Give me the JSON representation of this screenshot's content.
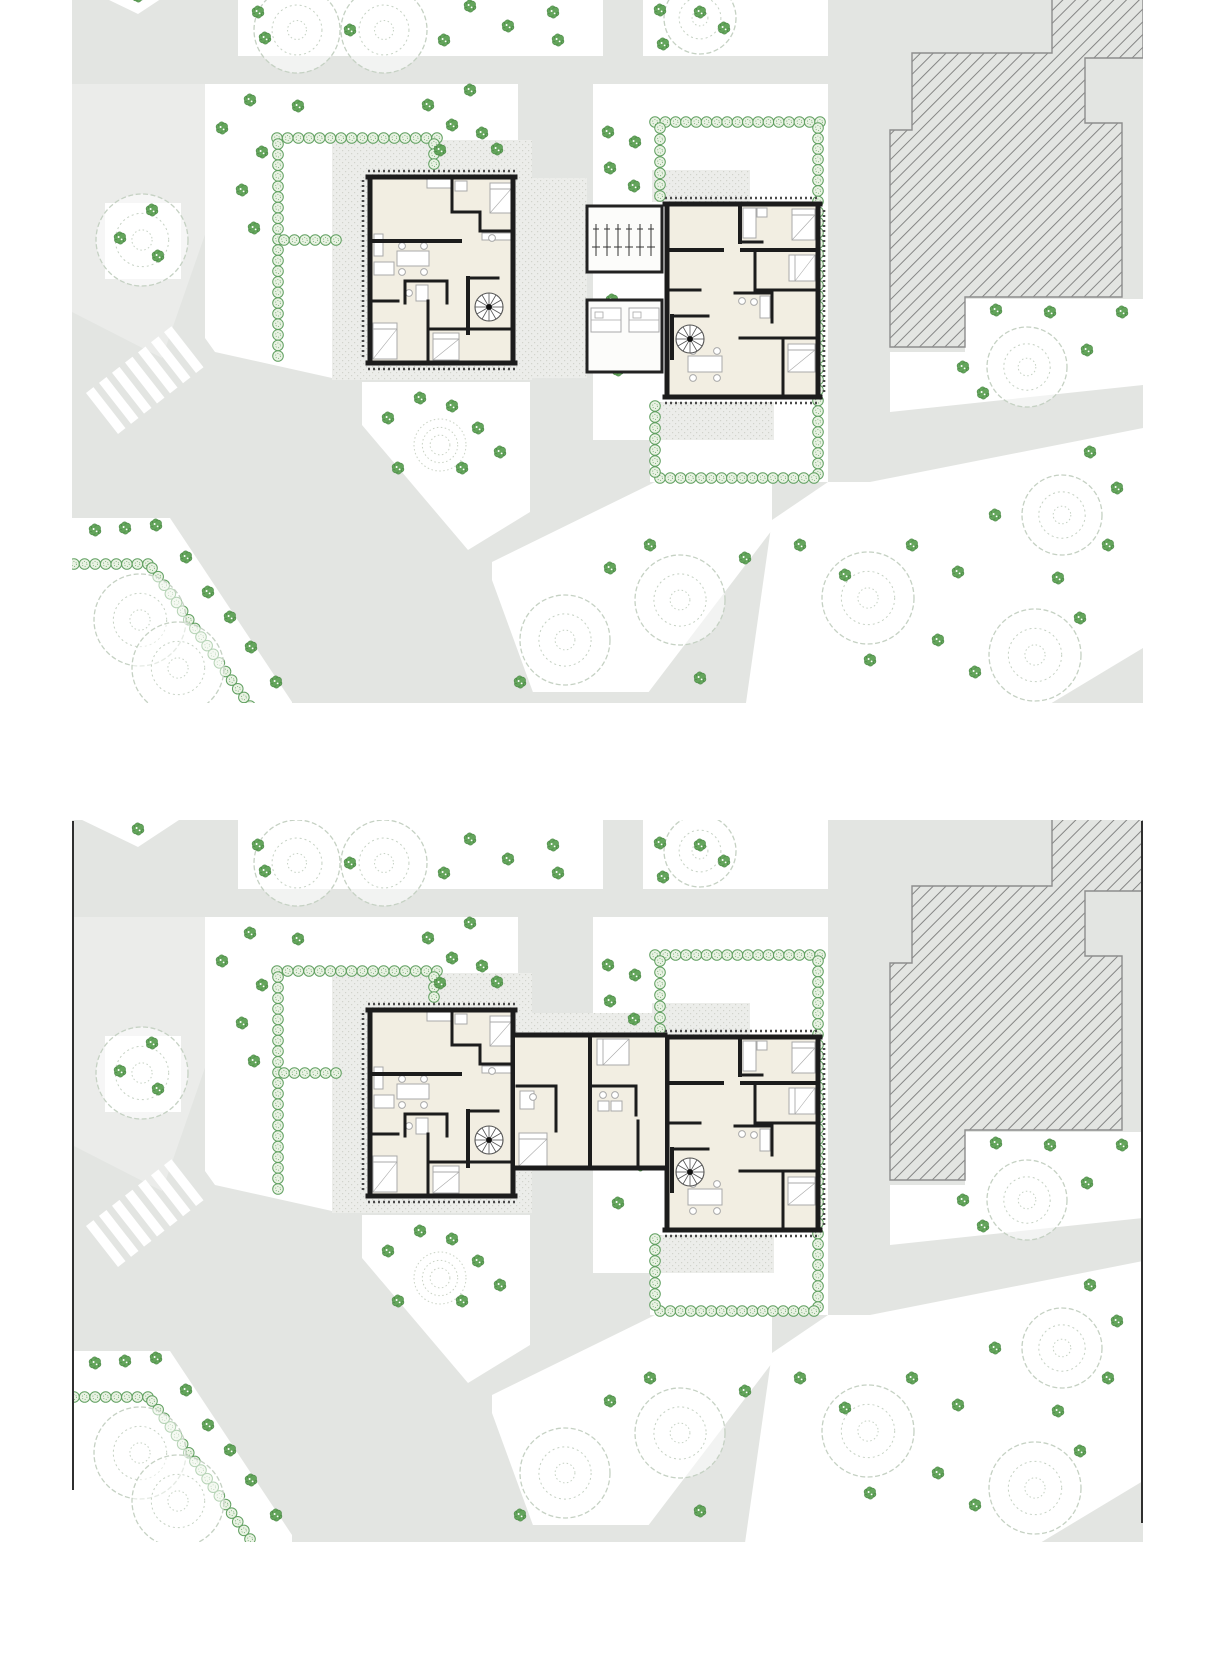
{
  "figure": {
    "panel_count": 2,
    "kind": "architectural-site-floor-plans"
  },
  "colors": {
    "page_bg": "#ffffff",
    "road": "#e3e5e2",
    "road_light": "#ecedec",
    "garden": "#ffffff",
    "patio_bg": "#ecedea",
    "patio_dot": "#d2d3cc",
    "floor": "#f2eee2",
    "wall": "#1c1c1c",
    "furniture": "#a9a9a9",
    "hedge_stroke": "#61a061",
    "hedge_fill": "#e9f2e3",
    "bush_fill": "#64a55c",
    "bush_stroke": "#3e7d3a",
    "tree_stroke": "#c5d1c3",
    "hatch_line": "#6e6e6e",
    "hatch_edge": "#8d8d8d",
    "shed_wall": "#222222",
    "trim": "#4a4a4a",
    "border": "#2f2f2f",
    "crosswalk": "#ffffff",
    "mound": "#c9d2c4",
    "stair": "#555555"
  },
  "panels": [
    {
      "id": "site-plan-panel-upper",
      "top": 0,
      "width": 1071,
      "height": 703,
      "view": [
        72,
        0,
        1071,
        703
      ],
      "variant": "detached",
      "border": false
    },
    {
      "id": "site-plan-panel-lower",
      "top": 820,
      "width": 1071,
      "height": 722,
      "view": [
        72,
        -13,
        1071,
        722
      ],
      "variant": "connected",
      "border": true
    }
  ],
  "site": {
    "base": [
      72,
      -15,
      1071,
      725
    ],
    "light_paving": [
      [
        [
          72,
          84
        ],
        [
          238,
          84
        ],
        [
          238,
          140
        ],
        [
          162,
          358
        ],
        [
          72,
          312
        ]
      ]
    ],
    "gardens": [
      [
        [
          78,
          -15
        ],
        [
          182,
          -15
        ],
        [
          138,
          14
        ]
      ],
      [
        [
          238,
          -15
        ],
        [
          603,
          -15
        ],
        [
          603,
          56
        ],
        [
          238,
          56
        ]
      ],
      [
        [
          643,
          -15
        ],
        [
          828,
          -15
        ],
        [
          828,
          56
        ],
        [
          643,
          56
        ]
      ],
      [
        [
          205,
          84
        ],
        [
          518,
          84
        ],
        [
          518,
          142
        ],
        [
          332,
          142
        ],
        [
          332,
          378
        ],
        [
          215,
          352
        ],
        [
          205,
          338
        ]
      ],
      [
        [
          593,
          84
        ],
        [
          828,
          84
        ],
        [
          828,
          482
        ],
        [
          650,
          482
        ],
        [
          650,
          440
        ],
        [
          593,
          440
        ]
      ],
      [
        [
          362,
          382
        ],
        [
          530,
          382
        ],
        [
          530,
          512
        ],
        [
          468,
          550
        ],
        [
          362,
          425
        ]
      ],
      [
        [
          492,
          562
        ],
        [
          655,
          482
        ],
        [
          772,
          482
        ],
        [
          772,
          530
        ],
        [
          638,
          706
        ],
        [
          538,
          706
        ],
        [
          492,
          580
        ]
      ],
      [
        [
          828,
          482
        ],
        [
          870,
          482
        ],
        [
          1143,
          428
        ],
        [
          1143,
          710
        ],
        [
          745,
          710
        ],
        [
          772,
          520
        ]
      ],
      [
        [
          890,
          352
        ],
        [
          965,
          352
        ],
        [
          965,
          299
        ],
        [
          1143,
          299
        ],
        [
          1143,
          385
        ],
        [
          890,
          412
        ]
      ],
      [
        [
          72,
          518
        ],
        [
          170,
          518
        ],
        [
          292,
          702
        ],
        [
          292,
          710
        ],
        [
          72,
          710
        ]
      ],
      [
        [
          105,
          203
        ],
        [
          181,
          203
        ],
        [
          181,
          279
        ],
        [
          105,
          279
        ]
      ]
    ],
    "road_strips": [
      [
        [
          300,
          692
        ],
        [
          743,
          692
        ],
        [
          743,
          710
        ],
        [
          300,
          710
        ]
      ],
      [
        [
          1040,
          710
        ],
        [
          1143,
          648
        ],
        [
          1143,
          710
        ]
      ]
    ],
    "patios": [
      [
        332,
        140,
        200,
        240
      ],
      [
        652,
        170,
        98,
        32
      ],
      [
        658,
        402,
        116,
        38
      ]
    ],
    "patios_detached": [
      [
        518,
        178,
        69,
        200
      ]
    ],
    "patios_connected": [
      [
        518,
        180,
        147,
        20
      ]
    ],
    "hatch_building": [
      [
        1052,
        -15
      ],
      [
        1143,
        -15
      ],
      [
        1143,
        58
      ],
      [
        1085,
        58
      ],
      [
        1085,
        123
      ],
      [
        1122,
        123
      ],
      [
        1122,
        297
      ],
      [
        965,
        297
      ],
      [
        965,
        347
      ],
      [
        890,
        347
      ],
      [
        890,
        130
      ],
      [
        912,
        130
      ],
      [
        912,
        53
      ],
      [
        1052,
        53
      ]
    ],
    "hedges": [
      [
        [
          277,
          138
        ],
        [
          437,
          138
        ]
      ],
      [
        [
          434,
          144
        ],
        [
          434,
          164
        ]
      ],
      [
        [
          278,
          144
        ],
        [
          278,
          356
        ]
      ],
      [
        [
          284,
          240
        ],
        [
          336,
          240
        ]
      ],
      [
        [
          655,
          122
        ],
        [
          820,
          122
        ]
      ],
      [
        [
          660,
          128
        ],
        [
          660,
          196
        ]
      ],
      [
        [
          818,
          128
        ],
        [
          818,
          474
        ]
      ],
      [
        [
          660,
          478
        ],
        [
          814,
          478
        ]
      ],
      [
        [
          655,
          406
        ],
        [
          655,
          472
        ]
      ],
      [
        [
          74,
          564
        ],
        [
          148,
          564
        ]
      ],
      [
        [
          152,
          568
        ],
        [
          250,
          706
        ]
      ]
    ],
    "crosswalk": {
      "x": 118,
      "y": 434,
      "rotate": -38,
      "count": 7,
      "stripe_w": 9.5,
      "stripe_l": 52,
      "step": 16.5
    },
    "mound": {
      "x": 440,
      "y": 445,
      "r": 26
    },
    "trees": [
      [
        297,
        30,
        43
      ],
      [
        384,
        30,
        43
      ],
      [
        700,
        18,
        36
      ],
      [
        142,
        240,
        46
      ],
      [
        140,
        620,
        46
      ],
      [
        178,
        668,
        46
      ],
      [
        565,
        640,
        45
      ],
      [
        680,
        600,
        45
      ],
      [
        868,
        598,
        46
      ],
      [
        1062,
        515,
        40
      ],
      [
        1035,
        655,
        46
      ],
      [
        1027,
        367,
        40
      ]
    ],
    "bushes": [
      [
        258,
        12
      ],
      [
        265,
        38
      ],
      [
        350,
        30
      ],
      [
        444,
        40
      ],
      [
        470,
        6
      ],
      [
        508,
        26
      ],
      [
        553,
        12
      ],
      [
        558,
        40
      ],
      [
        660,
        10
      ],
      [
        663,
        44
      ],
      [
        700,
        12
      ],
      [
        724,
        28
      ],
      [
        250,
        100
      ],
      [
        222,
        128
      ],
      [
        298,
        106
      ],
      [
        262,
        152
      ],
      [
        242,
        190
      ],
      [
        254,
        228
      ],
      [
        470,
        90
      ],
      [
        428,
        105
      ],
      [
        452,
        125
      ],
      [
        482,
        133
      ],
      [
        440,
        150
      ],
      [
        497,
        149
      ],
      [
        608,
        132
      ],
      [
        635,
        142
      ],
      [
        610,
        168
      ],
      [
        634,
        186
      ],
      [
        612,
        300
      ],
      [
        640,
        332
      ],
      [
        618,
        370
      ],
      [
        120,
        238
      ],
      [
        152,
        210
      ],
      [
        158,
        256
      ],
      [
        388,
        418
      ],
      [
        420,
        398
      ],
      [
        452,
        406
      ],
      [
        478,
        428
      ],
      [
        398,
        468
      ],
      [
        462,
        468
      ],
      [
        500,
        452
      ],
      [
        610,
        568
      ],
      [
        650,
        545
      ],
      [
        700,
        678
      ],
      [
        745,
        558
      ],
      [
        520,
        682
      ],
      [
        800,
        545
      ],
      [
        845,
        575
      ],
      [
        912,
        545
      ],
      [
        958,
        572
      ],
      [
        995,
        515
      ],
      [
        938,
        640
      ],
      [
        975,
        672
      ],
      [
        1090,
        452
      ],
      [
        1117,
        488
      ],
      [
        1108,
        545
      ],
      [
        1058,
        578
      ],
      [
        1080,
        618
      ],
      [
        870,
        660
      ],
      [
        996,
        310
      ],
      [
        1050,
        312
      ],
      [
        1122,
        312
      ],
      [
        1087,
        350
      ],
      [
        963,
        367
      ],
      [
        983,
        393
      ],
      [
        95,
        530
      ],
      [
        125,
        528
      ],
      [
        156,
        525
      ],
      [
        186,
        557
      ],
      [
        208,
        592
      ],
      [
        230,
        617
      ],
      [
        251,
        647
      ],
      [
        276,
        682
      ],
      [
        138,
        -4
      ]
    ],
    "building_left": {
      "fill": [
        368,
        177,
        147,
        186
      ],
      "walls": [
        [
          368,
          177,
          515,
          177,
          5
        ],
        [
          368,
          363,
          515,
          363,
          5
        ],
        [
          370,
          177,
          370,
          363,
          5
        ],
        [
          513,
          177,
          513,
          363,
          5
        ],
        [
          370,
          241,
          460,
          241,
          4
        ],
        [
          452,
          179,
          452,
          212,
          3
        ],
        [
          452,
          212,
          480,
          212,
          3
        ],
        [
          480,
          212,
          480,
          231,
          3
        ],
        [
          480,
          231,
          513,
          231,
          3
        ],
        [
          370,
          301,
          398,
          301,
          3
        ],
        [
          428,
          301,
          428,
          363,
          3
        ],
        [
          428,
          329,
          513,
          329,
          3
        ],
        [
          468,
          278,
          468,
          333,
          4
        ],
        [
          468,
          278,
          498,
          278,
          3
        ],
        [
          405,
          281,
          447,
          281,
          3
        ],
        [
          405,
          281,
          405,
          303,
          3
        ],
        [
          447,
          281,
          447,
          303,
          3
        ]
      ],
      "stair": [
        489,
        307,
        14
      ],
      "beds": [
        [
          490,
          183,
          21,
          30
        ],
        [
          373,
          323,
          24,
          36
        ],
        [
          433,
          333,
          26,
          27
        ]
      ],
      "tables": [
        [
          397,
          251,
          32,
          15
        ]
      ],
      "chairs": [
        [
          402,
          246
        ],
        [
          424,
          246
        ],
        [
          402,
          272
        ],
        [
          424,
          272
        ]
      ],
      "misc": [
        [
          427,
          179,
          24,
          9
        ],
        [
          455,
          181,
          12,
          10
        ],
        [
          482,
          233,
          31,
          7
        ],
        [
          374,
          262,
          20,
          13
        ],
        [
          416,
          285,
          12,
          16
        ],
        [
          374,
          234,
          9,
          22
        ]
      ],
      "dots": [
        [
          409,
          293
        ],
        [
          492,
          238
        ]
      ]
    },
    "building_right": {
      "fill": [
        665,
        204,
        155,
        193
      ],
      "walls": [
        [
          665,
          204,
          820,
          204,
          5
        ],
        [
          665,
          397,
          820,
          397,
          5
        ],
        [
          667,
          204,
          667,
          397,
          5
        ],
        [
          818,
          204,
          818,
          397,
          5
        ],
        [
          740,
          206,
          740,
          242,
          4
        ],
        [
          740,
          242,
          762,
          242,
          3
        ],
        [
          667,
          250,
          722,
          250,
          4
        ],
        [
          742,
          250,
          818,
          250,
          4
        ],
        [
          755,
          252,
          755,
          290,
          3
        ],
        [
          755,
          290,
          818,
          290,
          3
        ],
        [
          667,
          290,
          700,
          290,
          3
        ],
        [
          672,
          316,
          672,
          358,
          4
        ],
        [
          672,
          316,
          708,
          316,
          3
        ],
        [
          735,
          293,
          772,
          293,
          3
        ],
        [
          772,
          293,
          772,
          322,
          3
        ],
        [
          740,
          338,
          818,
          338,
          3
        ],
        [
          783,
          338,
          783,
          397,
          3
        ]
      ],
      "stair": [
        690,
        339,
        14
      ],
      "beds": [
        [
          792,
          209,
          23,
          31
        ],
        [
          789,
          255,
          26,
          26
        ],
        [
          788,
          344,
          27,
          28
        ]
      ],
      "tables": [
        [
          688,
          356,
          34,
          16
        ]
      ],
      "chairs": [
        [
          693,
          351
        ],
        [
          717,
          351
        ],
        [
          693,
          378
        ],
        [
          717,
          378
        ]
      ],
      "misc": [
        [
          743,
          208,
          13,
          30
        ],
        [
          757,
          208,
          10,
          9
        ],
        [
          760,
          296,
          10,
          22
        ]
      ],
      "dots": [
        [
          742,
          301
        ],
        [
          754,
          302
        ]
      ]
    },
    "trim_dashes": [
      [
        368,
        171,
        515,
        171
      ],
      [
        368,
        369,
        515,
        369
      ],
      [
        363,
        180,
        363,
        360
      ],
      [
        665,
        198,
        820,
        198
      ],
      [
        665,
        403,
        820,
        403
      ],
      [
        824,
        210,
        824,
        392
      ]
    ],
    "sheds": {
      "rooms": [
        [
          587,
          206,
          75,
          66
        ],
        [
          587,
          300,
          75,
          72
        ]
      ],
      "bikes": {
        "x0": 596,
        "step": 11,
        "count": 6,
        "y1": 224,
        "y2": 256
      },
      "shelves": [
        [
          591,
          308,
          30,
          24
        ],
        [
          629,
          308,
          30,
          24
        ]
      ]
    },
    "connector": {
      "fill": [
        515,
        202,
        150,
        133
      ],
      "walls": [
        [
          515,
          202,
          665,
          202,
          5
        ],
        [
          515,
          335,
          665,
          335,
          5
        ],
        [
          590,
          202,
          590,
          335,
          4
        ],
        [
          638,
          288,
          638,
          335,
          3
        ],
        [
          556,
          253,
          556,
          298,
          3
        ],
        [
          517,
          253,
          556,
          253,
          3
        ],
        [
          592,
          253,
          636,
          253,
          3
        ],
        [
          636,
          253,
          636,
          282,
          3
        ]
      ],
      "beds": [
        [
          597,
          206,
          32,
          26
        ],
        [
          519,
          300,
          28,
          33
        ]
      ],
      "misc": [
        [
          520,
          258,
          14,
          18
        ],
        [
          598,
          268,
          11,
          10
        ],
        [
          611,
          268,
          11,
          10
        ]
      ],
      "dots": [
        [
          533,
          264
        ],
        [
          603,
          262
        ],
        [
          615,
          262
        ]
      ]
    },
    "borders": {
      "left_y": [
        -12,
        657
      ],
      "right_y": [
        -12,
        690
      ]
    }
  }
}
